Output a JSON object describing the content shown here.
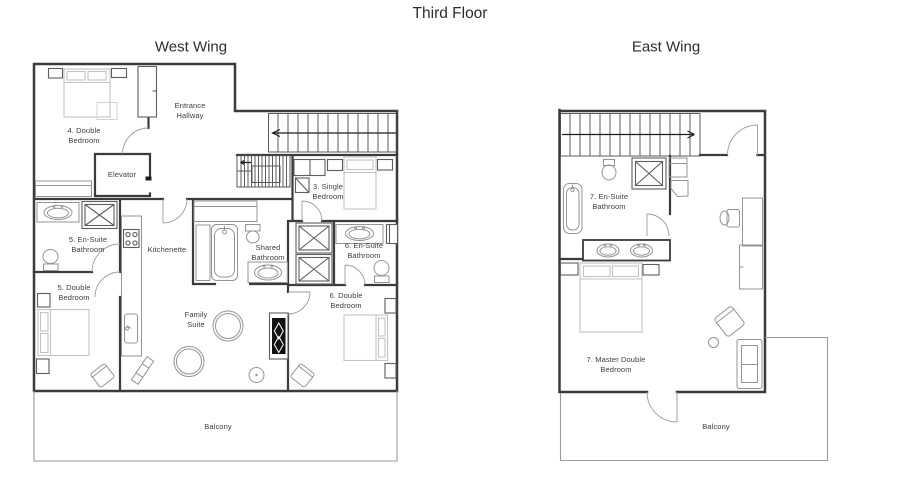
{
  "floor_title": "Third Floor",
  "west_wing": {
    "title": "West Wing",
    "labels": {
      "bedroom4": "4. Double\nBedroom",
      "entrance": "Entrance\nHallway",
      "elevator": "Elevator",
      "bedroom3": "3. Single\nBedroom",
      "ensuite5": "5. En-Suite\nBathroom",
      "kitchenette": "Kitchenette",
      "shared_bathroom": "Shared\nBathroom",
      "ensuite6": "6. En-Suite\nBathroom",
      "bedroom5": "5. Double\nBedroom",
      "bedroom6": "6. Double\nBedroom",
      "family_suite": "Family\nSuite",
      "balcony": "Balcony"
    }
  },
  "east_wing": {
    "title": "East Wing",
    "labels": {
      "ensuite7": "7. En-Suite\nBathroom",
      "master_bedroom": "7. Master Double\nBedroom",
      "balcony": "Balcony"
    }
  },
  "colors": {
    "wall": "#3b3b3b",
    "fixture": "#949494",
    "bed": "#c3c3c3",
    "text": "#3e3e3e",
    "background": "#ffffff"
  }
}
